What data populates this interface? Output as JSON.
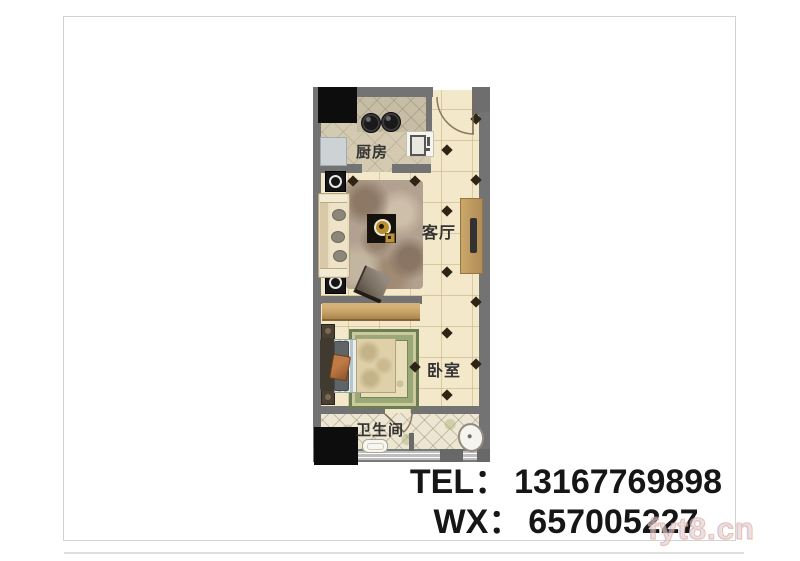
{
  "floorplan": {
    "rooms": [
      {
        "id": "kitchen",
        "label": "厨房"
      },
      {
        "id": "living-room",
        "label": "客厅"
      },
      {
        "id": "bedroom",
        "label": "卧室"
      },
      {
        "id": "bathroom",
        "label": "卫生间"
      }
    ],
    "colors": {
      "wall": "#737373",
      "floor_cream": "#f3e8c9",
      "kitchen_floor": "#d4cab1",
      "bath_floor": "#ece6d3",
      "console_wood": "#c4a066",
      "bed_rug_green": "#77865b",
      "shaft_black": "#0d0d0d"
    }
  },
  "contact": {
    "tel_label": "TEL：",
    "tel_number": "13167769898",
    "wx_label": "WX：",
    "wx_number": "657005227"
  },
  "watermark": "fyt8.cn"
}
